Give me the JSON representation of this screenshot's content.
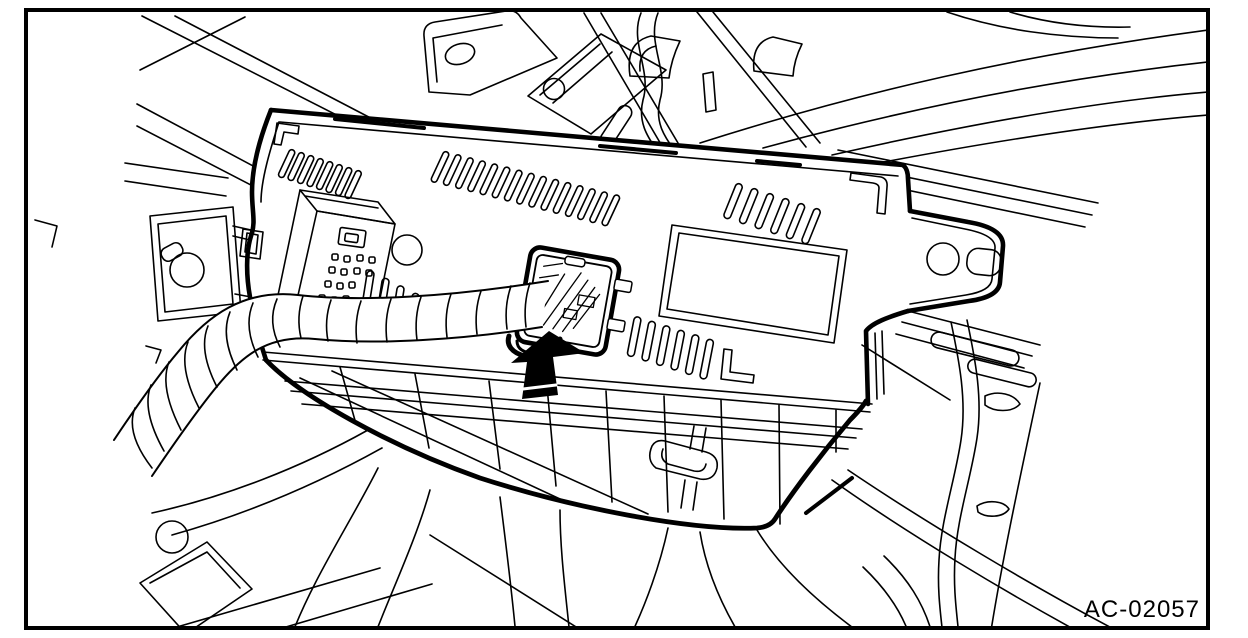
{
  "figure": {
    "code_label": "AC-02057"
  },
  "arrow": {
    "direction": "up"
  },
  "colors": {
    "background": "#ffffff",
    "line_color": "#000000",
    "arrow_fill": "#000000"
  }
}
